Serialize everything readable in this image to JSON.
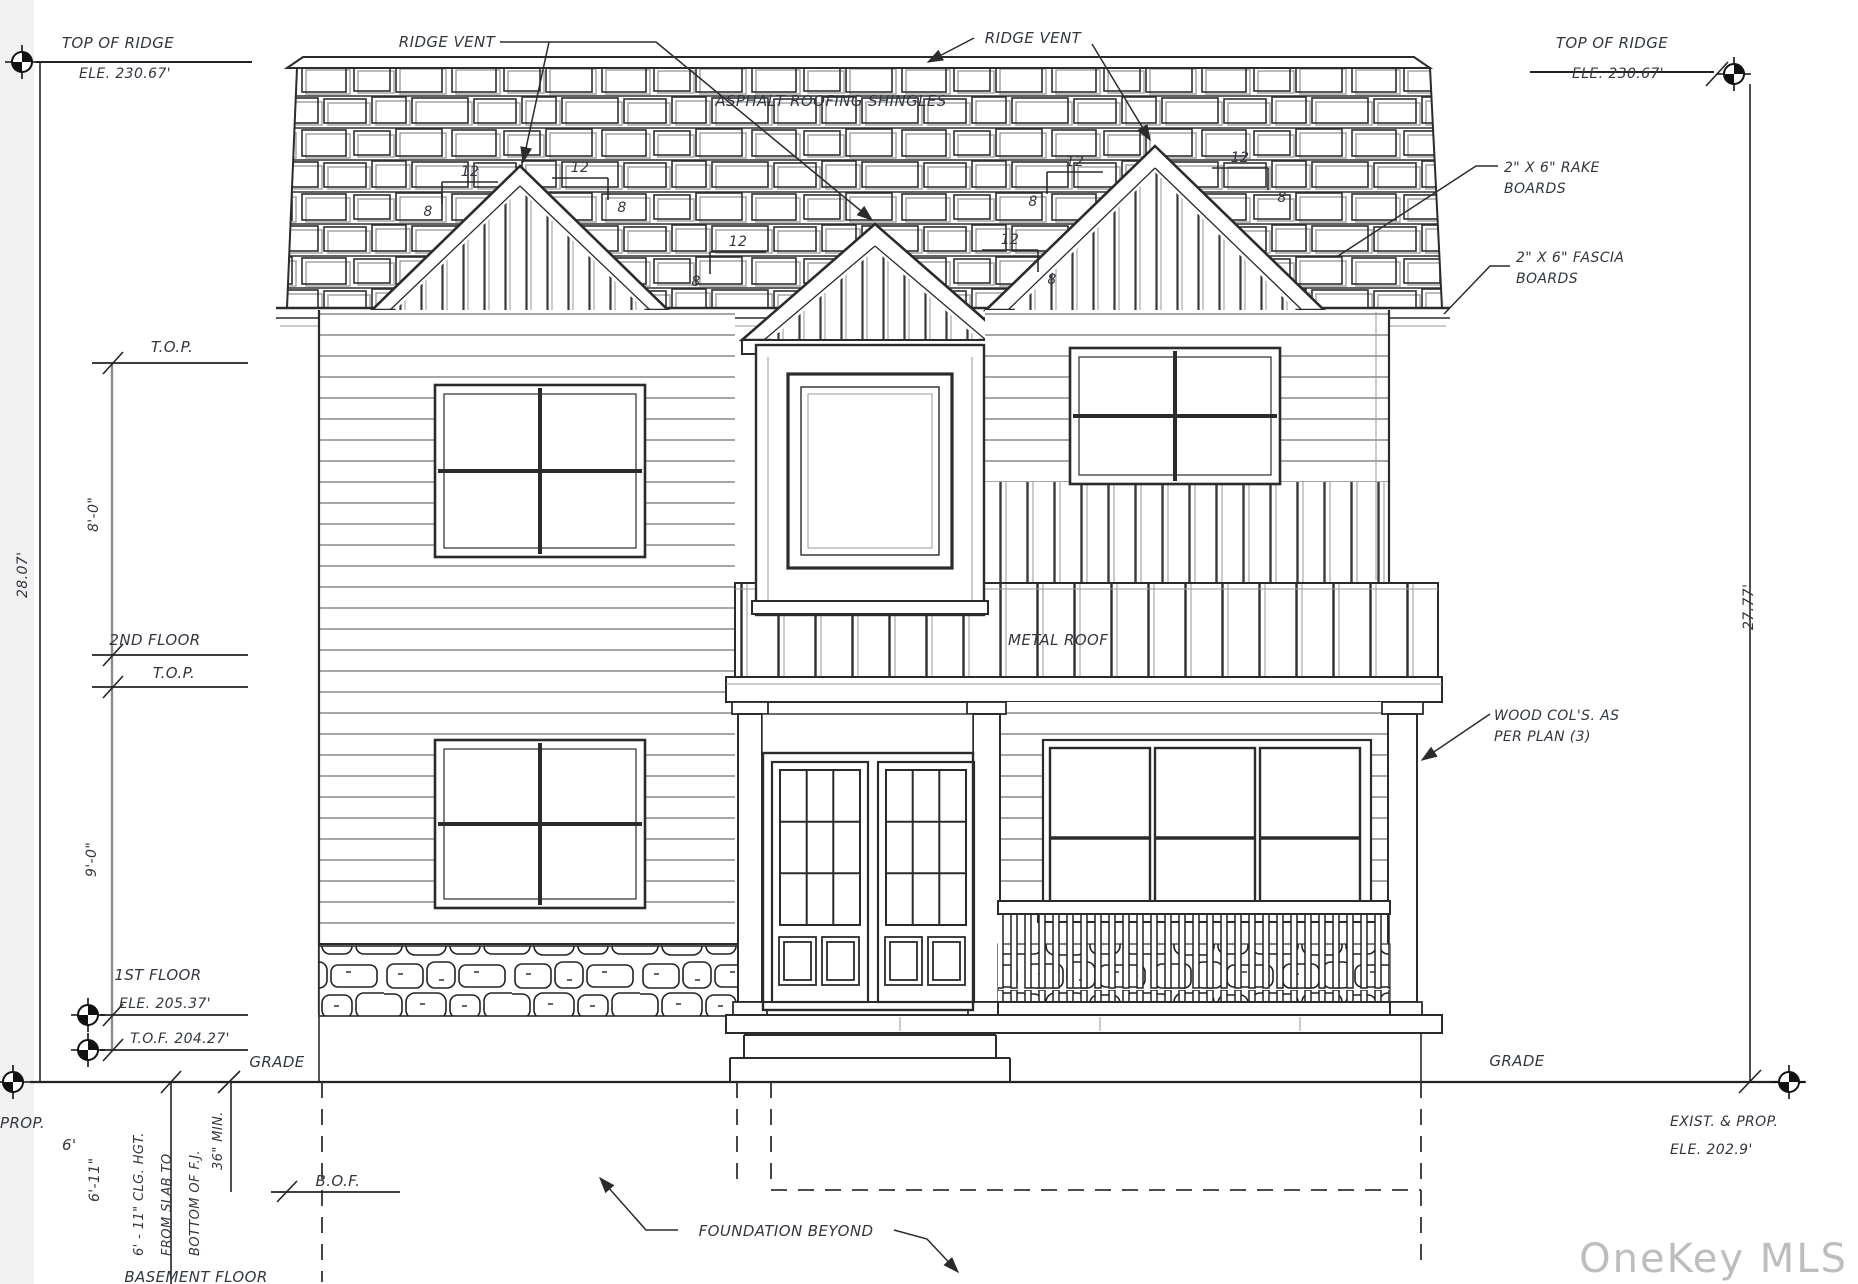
{
  "annotations": {
    "ridge_vent_left": "RIDGE VENT",
    "ridge_vent_right": "RIDGE VENT",
    "asphalt_shingles": "ASPHALT ROOFING SHINGLES",
    "rake_line1": "2\" X 6\" RAKE",
    "rake_line2": "BOARDS",
    "fascia_line1": "2\" X 6\" FASCIA",
    "fascia_line2": "BOARDS",
    "metal_roof": "METAL ROOF",
    "wood_cols_line1": "WOOD COL'S. AS",
    "wood_cols_line2": "PER PLAN (3)",
    "foundation_beyond": "FOUNDATION BEYOND"
  },
  "levels_left": {
    "top_of_ridge": "TOP OF RIDGE",
    "top_of_ridge_ele": "ELE. 230.67'",
    "top_plate_upper": "T.O.P.",
    "second_floor": "2ND FLOOR",
    "top_plate_lower": "T.O.P.",
    "first_floor": "1ST FLOOR",
    "first_floor_ele": "ELE. 205.37'",
    "tof": "T.O.F. 204.27'",
    "grade": "GRADE",
    "prop": "PROP.",
    "prop_ele_fragment": "6'",
    "bof": "B.O.F.",
    "basement_floor": "BASEMENT FLOOR"
  },
  "levels_right": {
    "top_of_ridge": "TOP OF RIDGE",
    "top_of_ridge_ele": "ELE. 230.67'",
    "grade": "GRADE",
    "exist_prop": "EXIST. & PROP.",
    "exist_prop_ele": "ELE. 202.9'"
  },
  "dimensions": {
    "overall_left": "28.07'",
    "overall_right": "27.77'",
    "second_floor_height": "8'-0\"",
    "first_floor_height": "9'-0\"",
    "basement_height": "6'-11\"",
    "clg_line1": "6' - 11\" CLG. HGT.",
    "clg_line2": "FROM SLAB TO",
    "clg_line3": "BOTTOM OF F.J.",
    "min_depth": "36\" MIN."
  },
  "slope": {
    "run": "12",
    "rise": "8"
  },
  "watermark": "OneKey MLS"
}
